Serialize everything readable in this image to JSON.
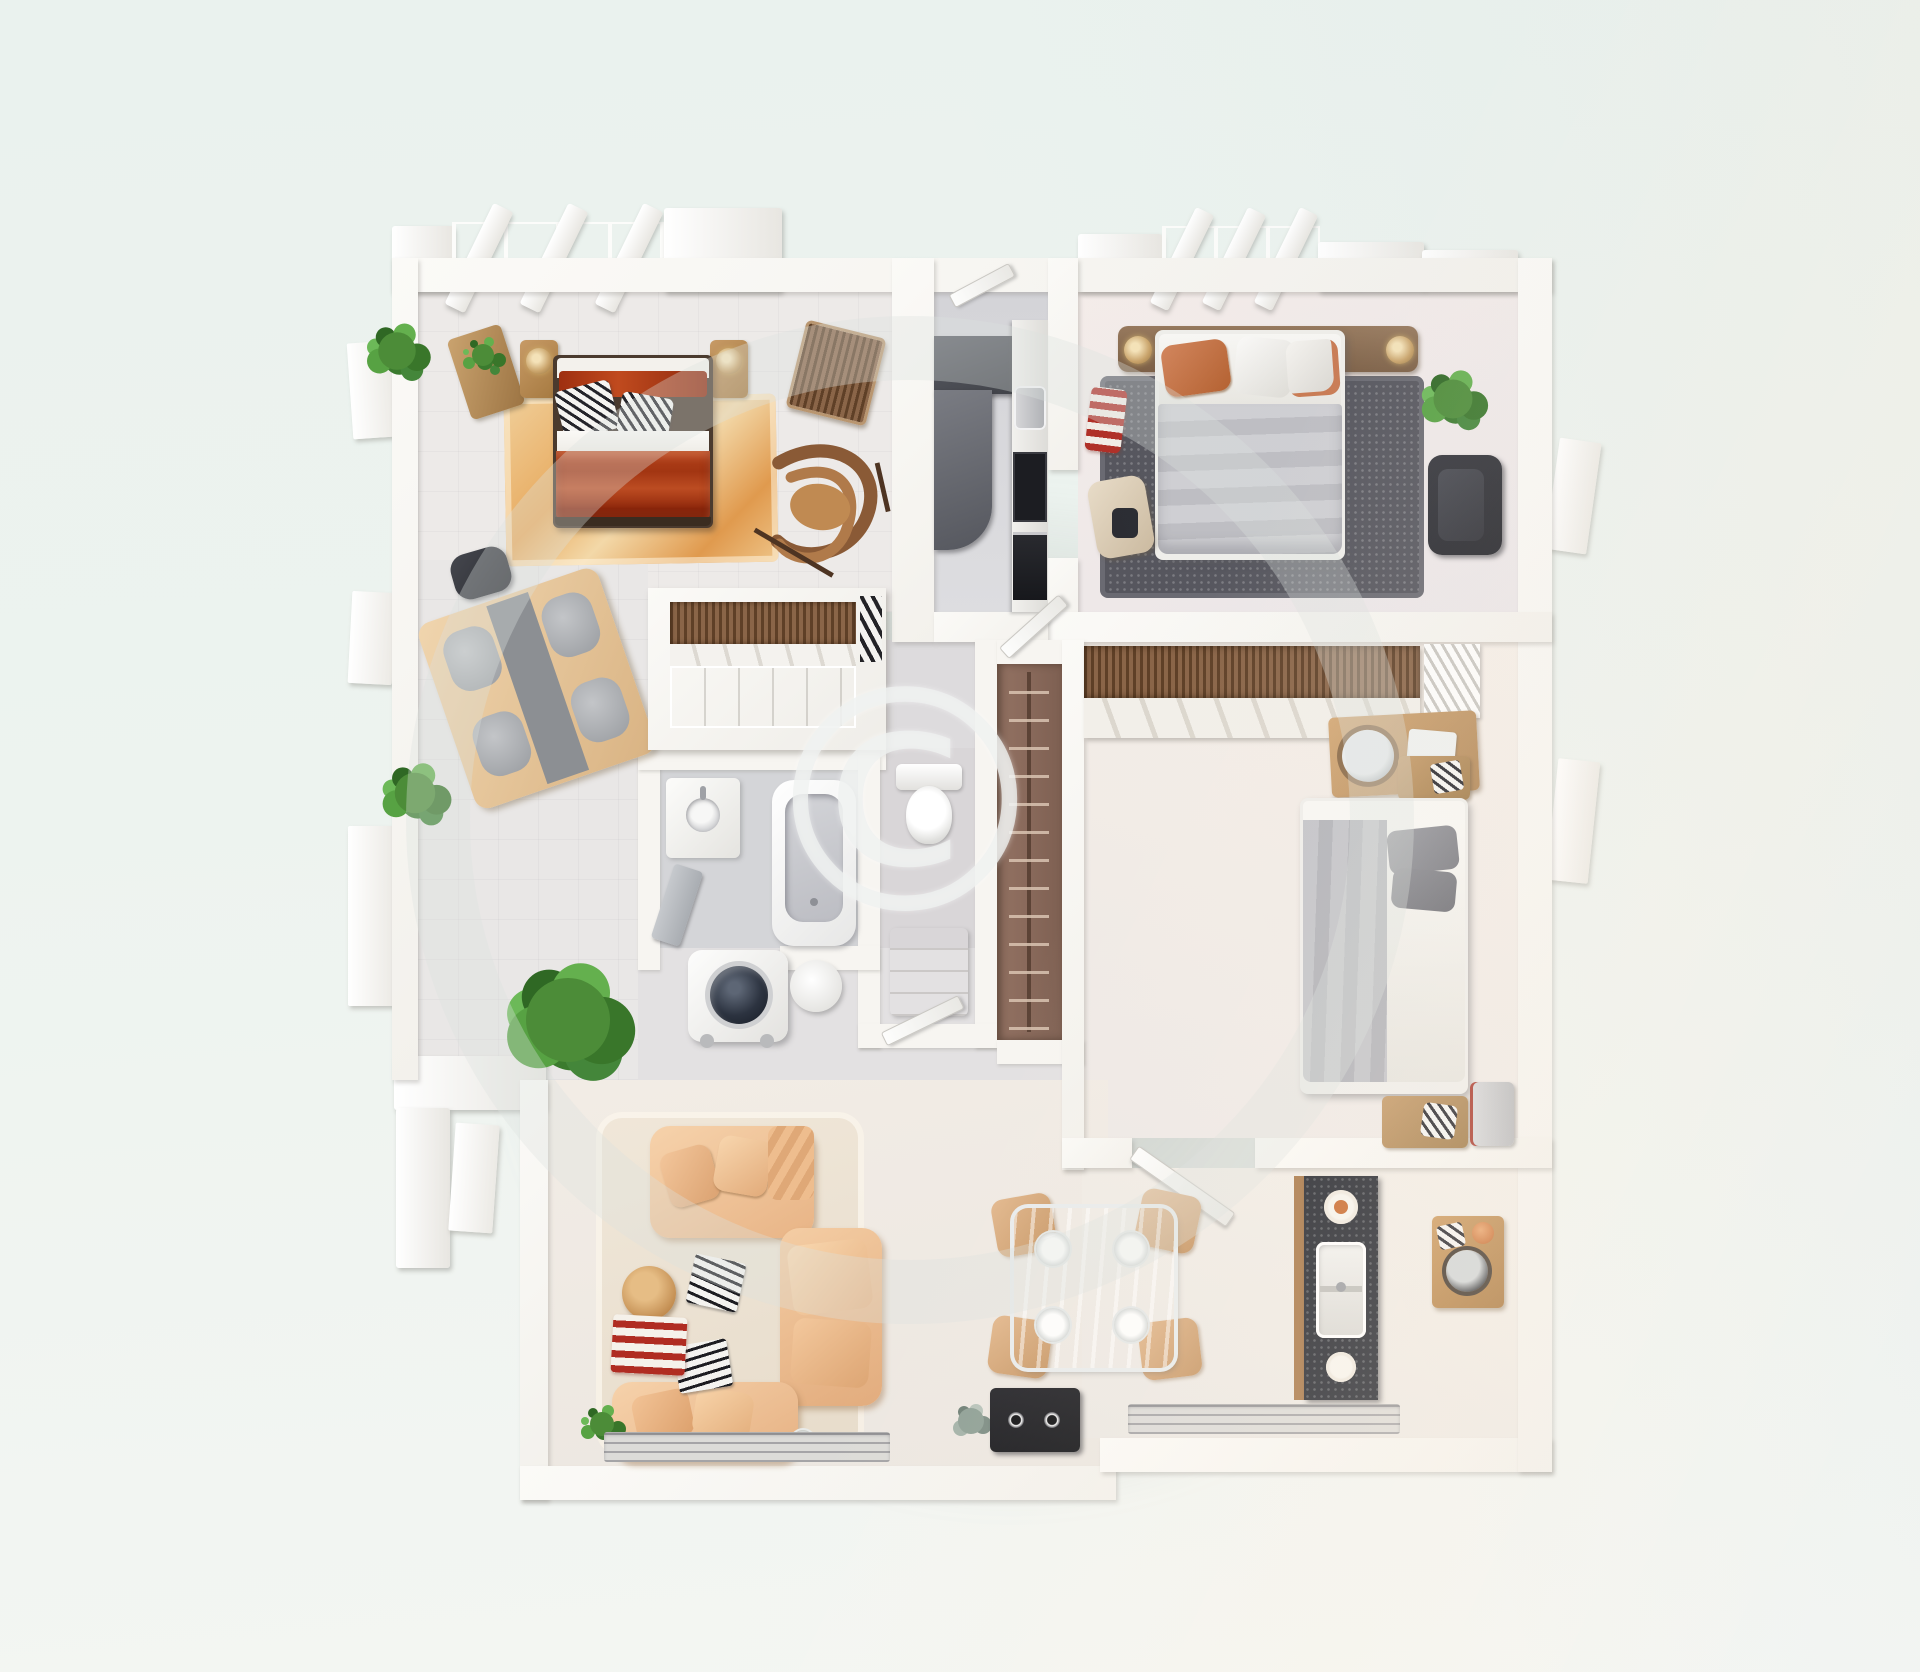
{
  "watermark": {
    "symbol": "©"
  },
  "scene": {
    "type": "3d-floor-plan-top-view",
    "background_color": "#edf3ef",
    "wall_color": "#f8f7f3",
    "shadow_color": "#9aa09c"
  },
  "palette": {
    "master_bed_red": "#a93a16",
    "sofa_peach": "#f2c79f",
    "duvet_gray": "#c6c6ca",
    "rug_tan": "#ecbf8a",
    "rug_charcoal": "#56565e",
    "counter_dark": "#4a4c54",
    "granite_dark": "#23262e",
    "wood_light": "#e6c9a1",
    "wood_mid": "#c0905c",
    "closet_brown": "#8a6a58",
    "plant_green": "#4c8c38",
    "floor_pale": "#edeae8",
    "floor_gray": "#d8d8db"
  },
  "rooms": [
    {
      "id": "master-bedroom",
      "furniture": [
        "double-bed-red",
        "nightstand-left",
        "nightstand-right",
        "table-lamp-gold",
        "console-table",
        "area-rug-tan",
        "slat-chair",
        "rocking-chair",
        "ottoman-dark",
        "four-seat-game-table",
        "potted-plants"
      ]
    },
    {
      "id": "kitchen-corridor",
      "furniture": [
        "l-counter-dark",
        "toaster-silver",
        "cooktop-black",
        "dishwasher-black"
      ]
    },
    {
      "id": "bedroom-top-right",
      "furniture": [
        "double-bed-gray",
        "headboard-brown",
        "table-lamps-gold",
        "rug-charcoal",
        "armchair-black",
        "potted-plant",
        "coat-rack",
        "side-chair"
      ]
    },
    {
      "id": "hall-wardrobe",
      "furniture": [
        "slatted-wardrobe",
        "open-shelf",
        "leaning-books"
      ]
    },
    {
      "id": "bathroom",
      "furniture": [
        "bathtub",
        "vanity-sink",
        "washing-machine",
        "round-side-table",
        "door-panel-gray"
      ]
    },
    {
      "id": "wc",
      "furniture": [
        "toilet",
        "storage-cabinet",
        "door-leaf"
      ]
    },
    {
      "id": "closet-corridor",
      "furniture": [
        "clothes-rail-hangers"
      ]
    },
    {
      "id": "bedroom-right",
      "furniture": [
        "slatted-wardrobe",
        "vanity-desk-round-mirror",
        "double-bed-gray-white",
        "nightstand-top",
        "nightstand-bottom",
        "mini-fridge-red"
      ]
    },
    {
      "id": "living-room",
      "furniture": [
        "sectional-sofa-peach",
        "coffee-table-round",
        "magazines",
        "striped-rug-red",
        "potted-plant-large",
        "potted-plant-small",
        "media-unit-black",
        "drinking-glass"
      ]
    },
    {
      "id": "dining-kitchen",
      "furniture": [
        "glass-dining-table",
        "dining-chairs-tan",
        "plates",
        "granite-counter",
        "double-sink",
        "prep-table-wood",
        "window"
      ]
    }
  ]
}
